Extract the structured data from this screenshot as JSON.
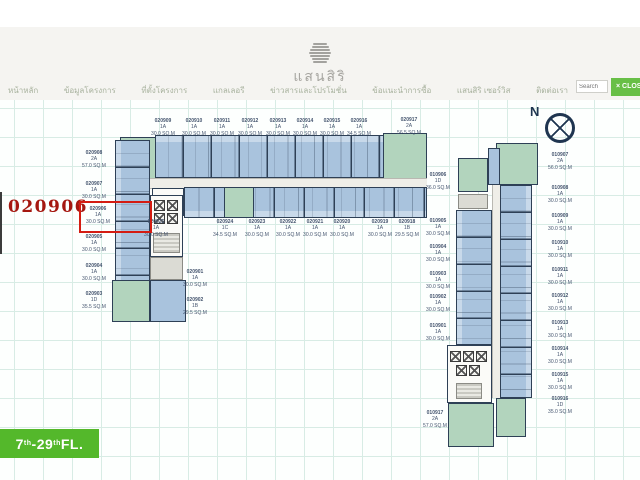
{
  "header": {
    "logo_text": "แสนสิริ",
    "nav_items": [
      "หน้าหลัก",
      "ข้อมูลโครงการ",
      "ที่ตั้งโครงการ",
      "แกลเลอรี",
      "ข่าวสารและโปรโมชั่น",
      "ข้อแนะนำการซื้อ",
      "แสนสิริ เซอร์วิส",
      "ติดต่อเรา"
    ],
    "search_placeholder": "Search",
    "close_label": "× CLOSE"
  },
  "plan": {
    "highlighted_unit": "020906",
    "compass_label": "N",
    "floor_badge": {
      "f1": "7",
      "s1": "th",
      "f2": "-29",
      "s2": "th",
      "suffix": " FL."
    },
    "unit_labels": [
      {
        "id": "020909",
        "type": "1A",
        "area": "30.0 SQ.M",
        "x": 148,
        "y": 18,
        "w": 30
      },
      {
        "id": "020910",
        "type": "1A",
        "area": "30.0 SQ.M",
        "x": 179,
        "y": 18,
        "w": 30
      },
      {
        "id": "020911",
        "type": "1A",
        "area": "30.0 SQ.M",
        "x": 207,
        "y": 18,
        "w": 30
      },
      {
        "id": "020912",
        "type": "1A",
        "area": "30.0 SQ.M",
        "x": 235,
        "y": 18,
        "w": 30
      },
      {
        "id": "020913",
        "type": "1A",
        "area": "30.0 SQ.M",
        "x": 263,
        "y": 18,
        "w": 30
      },
      {
        "id": "020914",
        "type": "1A",
        "area": "30.0 SQ.M",
        "x": 290,
        "y": 18,
        "w": 30
      },
      {
        "id": "020915",
        "type": "1A",
        "area": "30.0 SQ.M",
        "x": 317,
        "y": 18,
        "w": 30
      },
      {
        "id": "020916",
        "type": "1A",
        "area": "34.5 SQ.M",
        "x": 344,
        "y": 18,
        "w": 30
      },
      {
        "id": "020917",
        "type": "2A",
        "area": "56.5 SQ.M",
        "x": 391,
        "y": 17,
        "w": 36
      },
      {
        "id": "020908",
        "type": "2A",
        "area": "57.0 SQ.M",
        "x": 78,
        "y": 50,
        "w": 32
      },
      {
        "id": "020907",
        "type": "1A",
        "area": "30.0 SQ.M",
        "x": 78,
        "y": 81,
        "w": 32
      },
      {
        "id": "020906",
        "type": "1A",
        "area": "30.0 SQ.M",
        "x": 82,
        "y": 106,
        "w": 32
      },
      {
        "id": "020905",
        "type": "1A",
        "area": "30.0 SQ.M",
        "x": 78,
        "y": 134,
        "w": 32
      },
      {
        "id": "020904",
        "type": "1A",
        "area": "30.0 SQ.M",
        "x": 78,
        "y": 163,
        "w": 32
      },
      {
        "id": "020903",
        "type": "1D",
        "area": "35.5 SQ.M",
        "x": 78,
        "y": 191,
        "w": 32
      },
      {
        "id": "020901",
        "type": "1A",
        "area": "30.0 SQ.M",
        "x": 180,
        "y": 169,
        "w": 30
      },
      {
        "id": "020902",
        "type": "1B",
        "area": "29.5 SQ.M",
        "x": 180,
        "y": 197,
        "w": 30
      },
      {
        "id": "020925",
        "type": "1A",
        "area": "30.0 SQ.M",
        "x": 141,
        "y": 119,
        "w": 30
      },
      {
        "id": "020924",
        "type": "1C",
        "area": "34.5 SQ.M",
        "x": 210,
        "y": 119,
        "w": 30
      },
      {
        "id": "020923",
        "type": "1A",
        "area": "30.0 SQ.M",
        "x": 242,
        "y": 119,
        "w": 30
      },
      {
        "id": "020922",
        "type": "1A",
        "area": "30.0 SQ.M",
        "x": 273,
        "y": 119,
        "w": 30
      },
      {
        "id": "020921",
        "type": "1A",
        "area": "30.0 SQ.M",
        "x": 300,
        "y": 119,
        "w": 30
      },
      {
        "id": "020920",
        "type": "1A",
        "area": "30.0 SQ.M",
        "x": 327,
        "y": 119,
        "w": 30
      },
      {
        "id": "020919",
        "type": "1A",
        "area": "30.0 SQ.M",
        "x": 365,
        "y": 119,
        "w": 30
      },
      {
        "id": "020918",
        "type": "1B",
        "area": "29.5 SQ.M",
        "x": 392,
        "y": 119,
        "w": 30
      },
      {
        "id": "010907",
        "type": "2A",
        "area": "56.0 SQ.M",
        "x": 544,
        "y": 52,
        "w": 32
      },
      {
        "id": "010908",
        "type": "1A",
        "area": "30.0 SQ.M",
        "x": 544,
        "y": 85,
        "w": 32
      },
      {
        "id": "010909",
        "type": "1A",
        "area": "30.0 SQ.M",
        "x": 544,
        "y": 113,
        "w": 32
      },
      {
        "id": "010910",
        "type": "1A",
        "area": "30.0 SQ.M",
        "x": 544,
        "y": 140,
        "w": 32
      },
      {
        "id": "010911",
        "type": "1A",
        "area": "30.0 SQ.M",
        "x": 544,
        "y": 167,
        "w": 32
      },
      {
        "id": "010912",
        "type": "1A",
        "area": "30.0 SQ.M",
        "x": 544,
        "y": 193,
        "w": 32
      },
      {
        "id": "010913",
        "type": "1A",
        "area": "30.0 SQ.M",
        "x": 544,
        "y": 220,
        "w": 32
      },
      {
        "id": "010914",
        "type": "1A",
        "area": "30.0 SQ.M",
        "x": 544,
        "y": 246,
        "w": 32
      },
      {
        "id": "010915",
        "type": "1A",
        "area": "30.0 SQ.M",
        "x": 544,
        "y": 272,
        "w": 32
      },
      {
        "id": "010916",
        "type": "1D",
        "area": "35.0 SQ.M",
        "x": 544,
        "y": 296,
        "w": 32
      },
      {
        "id": "010906",
        "type": "1D",
        "area": "36.0 SQ.M",
        "x": 423,
        "y": 72,
        "w": 30
      },
      {
        "id": "010905",
        "type": "1A",
        "area": "30.0 SQ.M",
        "x": 423,
        "y": 118,
        "w": 30
      },
      {
        "id": "010904",
        "type": "1A",
        "area": "30.0 SQ.M",
        "x": 423,
        "y": 144,
        "w": 30
      },
      {
        "id": "010903",
        "type": "1A",
        "area": "30.0 SQ.M",
        "x": 423,
        "y": 171,
        "w": 30
      },
      {
        "id": "010902",
        "type": "1A",
        "area": "30.0 SQ.M",
        "x": 423,
        "y": 194,
        "w": 30
      },
      {
        "id": "010901",
        "type": "1A",
        "area": "30.0 SQ.M",
        "x": 423,
        "y": 223,
        "w": 30
      },
      {
        "id": "010917",
        "type": "2A",
        "area": "57.0 SQ.M",
        "x": 418,
        "y": 310,
        "w": 34
      }
    ]
  },
  "colors": {
    "unit_blue": "#a9c3dd",
    "unit_green": "#b2d4bd",
    "wall": "#2e4056",
    "highlight_red": "#d41c12",
    "badge_green": "#54b82b",
    "button_green": "#68bf47",
    "grid_line": "#d8ece5"
  }
}
